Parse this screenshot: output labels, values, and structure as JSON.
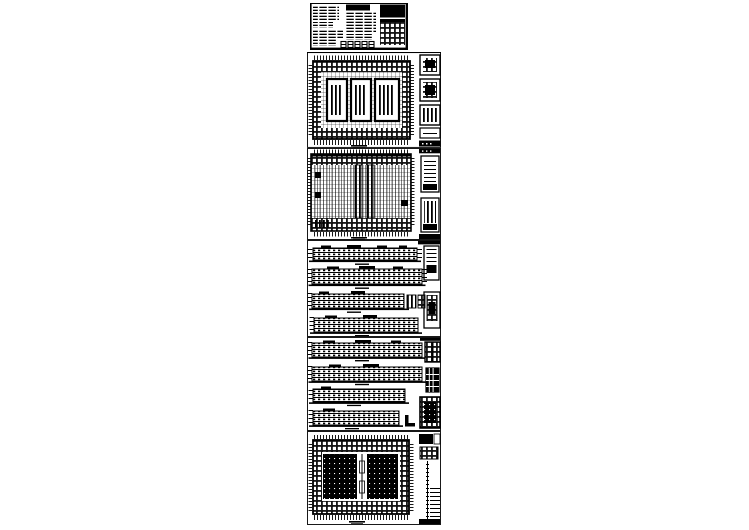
{
  "canvas": {
    "width": 749,
    "height": 530,
    "background": "#ffffff",
    "ink": "#000000"
  },
  "sheets": [
    {
      "id": "sheet-1-notes",
      "type": "design-notes-text-sheet",
      "x": 310,
      "y": 3,
      "w": 98,
      "h": 47
    },
    {
      "id": "sheet-2-floor-plan",
      "type": "floor-plan-with-details",
      "x": 307,
      "y": 52,
      "w": 134,
      "h": 96
    },
    {
      "id": "sheet-3-floor-plan",
      "type": "floor-plan-with-sections",
      "x": 307,
      "y": 148,
      "w": 134,
      "h": 92
    },
    {
      "id": "sheet-4-elevations",
      "type": "four-elevations-with-details",
      "x": 307,
      "y": 240,
      "w": 134,
      "h": 97
    },
    {
      "id": "sheet-5-elevations",
      "type": "four-elevations-with-details",
      "x": 307,
      "y": 337,
      "w": 134,
      "h": 94
    },
    {
      "id": "sheet-6-roof-plan",
      "type": "hatched-plan-with-details",
      "x": 307,
      "y": 431,
      "w": 134,
      "h": 94
    }
  ]
}
